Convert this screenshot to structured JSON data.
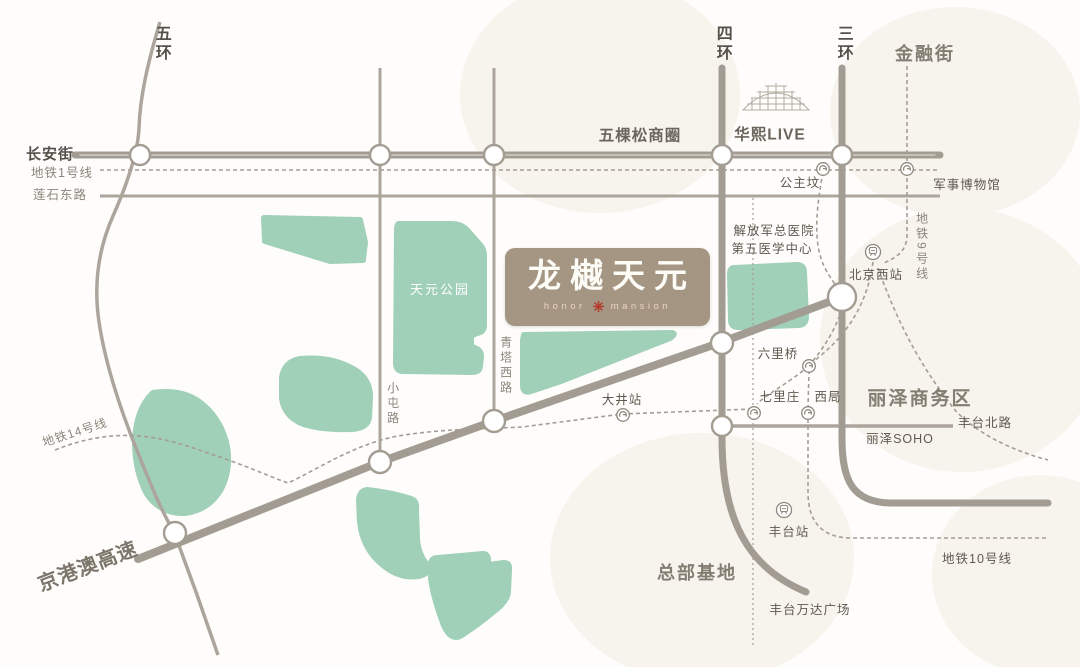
{
  "project": {
    "name": "龙樾天元",
    "subtitle_left": "honor",
    "subtitle_right": "mansion"
  },
  "ring_roads": {
    "ring5": "五环",
    "ring4": "四环",
    "ring3": "三环"
  },
  "roads": {
    "changan_street": "长安街",
    "lianshi_east_road": "莲石东路",
    "xiaotun_road": "小屯路",
    "qingta_west_road": "青塔西路",
    "fengtai_north_road": "丰台北路",
    "jinggangao_expressway": "京港澳高速"
  },
  "metro_lines": {
    "line1": "地铁1号线",
    "line9": "地铁9号线",
    "line10": "地铁10号线",
    "line14": "地铁14号线"
  },
  "stations": {
    "gongzhufen": "公主坟",
    "military_museum": "军事博物馆",
    "beijing_west_station": "北京西站",
    "liuliqiao": "六里桥",
    "qilizhuang": "七里庄",
    "xiju": "西局",
    "dajing_station": "大井站",
    "fengtai_station": "丰台站"
  },
  "landmarks": {
    "wukesong_business_district": "五棵松商圈",
    "huaxi_live": "华熙LIVE",
    "financial_street": "金融街",
    "pla_hospital_line1": "解放军总医院",
    "pla_hospital_line2": "第五医学中心",
    "tianyuan_park": "天元公园",
    "lize_business_district": "丽泽商务区",
    "lize_soho": "丽泽SOHO",
    "headquarters_base": "总部基地",
    "fengtai_wanda_plaza": "丰台万达广场"
  },
  "colors": {
    "road": "#a39c93",
    "road_thin": "#aca59c",
    "metro_dash": "#a49d93",
    "park_green": "#a0d0b8",
    "logo_background": "#a59683",
    "logo_text": "#fdfcf7",
    "logo_seal_red": "#b43b2d",
    "label_dark": "#55504a",
    "label_light": "#8b857b",
    "background_blob": "#f7f3ed"
  }
}
